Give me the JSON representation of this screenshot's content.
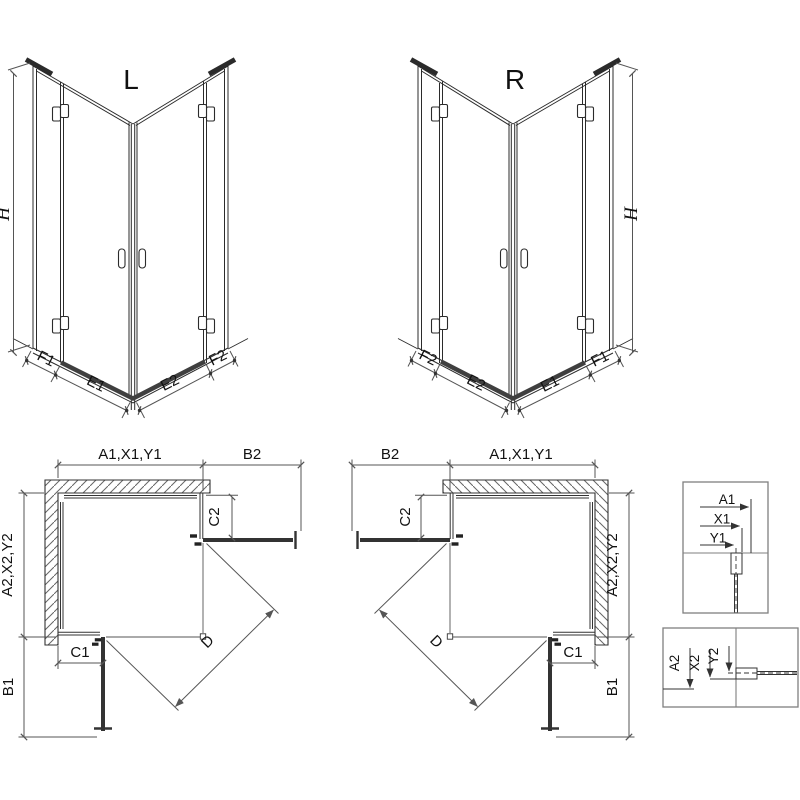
{
  "drawing": {
    "front_left": {
      "title": "L"
    },
    "front_right": {
      "title": "R"
    },
    "front_dims": {
      "height": "H",
      "f1": "F1",
      "e1": "E1",
      "e2": "E2",
      "f2": "F2"
    },
    "plan_dims": {
      "width_top": "A1,X1,Y1",
      "side_clearance": "B2",
      "side_fixed": "C2",
      "depth_side": "A2,X2,Y2",
      "front_fixed": "C1",
      "front_clearance": "B1",
      "diagonal_entry": "D"
    },
    "detail_top": {
      "a1": "A1",
      "x1": "X1",
      "y1": "Y1"
    },
    "detail_side": {
      "a2": "A2",
      "x2": "X2",
      "y2": "Y2"
    },
    "colors": {
      "line": "#2b2b2b",
      "dimension": "#555555",
      "threshold": "#3f3f3f",
      "hatch": "#666666",
      "detail_border": "#7f7f7f",
      "background": "#ffffff"
    }
  }
}
